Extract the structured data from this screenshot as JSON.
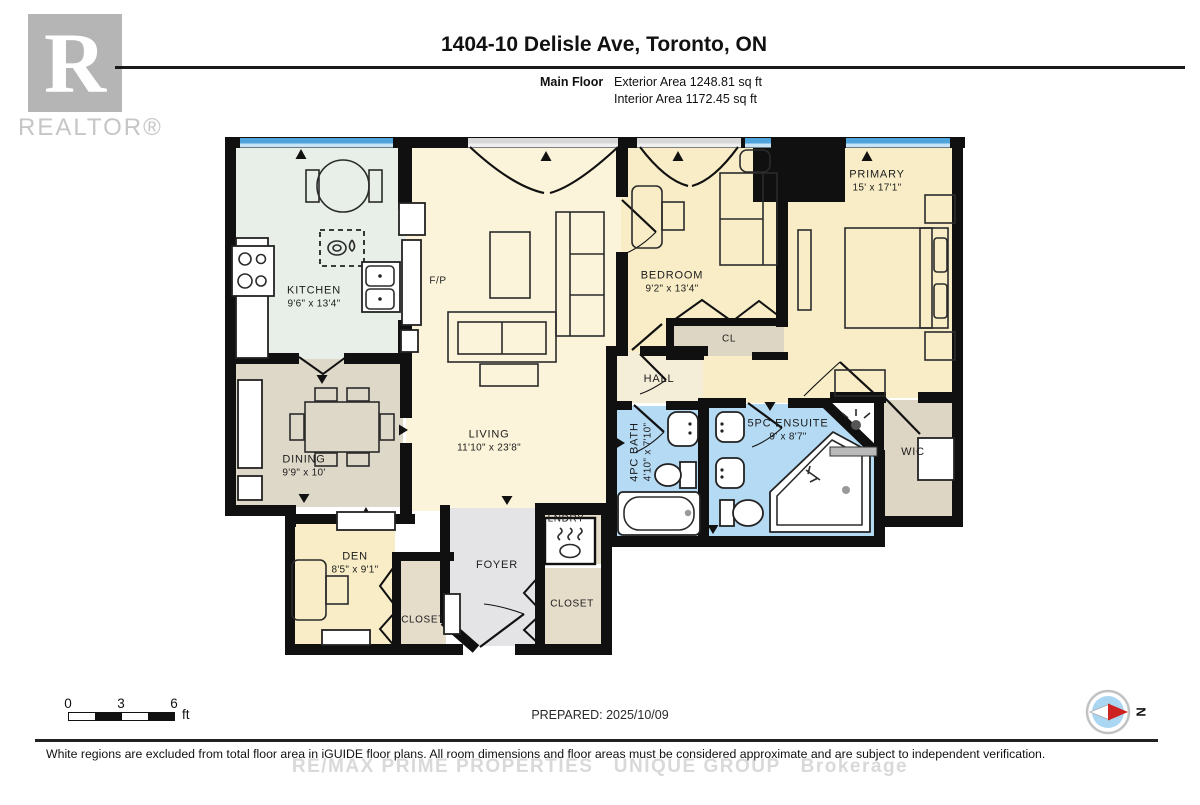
{
  "header": {
    "title": "1404-10 Delisle Ave, Toronto, ON",
    "floor_label": "Main Floor",
    "exterior_area": "Exterior Area 1248.81 sq ft",
    "interior_area": "Interior Area 1172.45 sq ft",
    "logo_letter": "R",
    "logo_word": "REALTOR®"
  },
  "rooms": {
    "kitchen": {
      "name": "KITCHEN",
      "dims": "9'6\" x 13'4\""
    },
    "living": {
      "name": "LIVING",
      "dims": "11'10\" x 23'8\""
    },
    "dining": {
      "name": "DINING",
      "dims": "9'9\" x 10'"
    },
    "den": {
      "name": "DEN",
      "dims": "8'5\" x 9'1\""
    },
    "bedroom": {
      "name": "BEDROOM",
      "dims": "9'2\" x 13'4\""
    },
    "primary": {
      "name": "PRIMARY",
      "dims": "15' x 17'1\""
    },
    "bath": {
      "name": "4PC BATH",
      "dims": "4'10\" x 7'10\""
    },
    "ensuite": {
      "name": "5PC ENSUITE",
      "dims": "9' x 8'7\""
    },
    "wic": {
      "name": "WIC"
    },
    "hall": {
      "name": "HALL"
    },
    "cl": {
      "name": "CL"
    },
    "foyer": {
      "name": "FOYER"
    },
    "laundry": {
      "name": "LNDRY"
    },
    "closet_den": {
      "name": "CLOSET"
    },
    "closet_foyer": {
      "name": "CLOSET"
    },
    "fireplace": {
      "name": "F/P"
    }
  },
  "footer": {
    "scale": {
      "ticks": [
        "0",
        "3",
        "6"
      ],
      "unit": "ft"
    },
    "prepared": "PREPARED: 2025/10/09",
    "compass_label": "N",
    "disclaimer": "White regions are excluded from total floor area in iGUIDE floor plans. All room dimensions and floor areas must be considered approximate and are subject to independent verification.",
    "watermark": "RE/MAX PRIME PROPERTIES   UNIQUE GROUP   Brokerage"
  },
  "colors": {
    "kitchen": "#e7efe8",
    "cream1": "#fbf4da",
    "cream2": "#f8edc7",
    "greige": "#ded6c5",
    "greige2": "#ded8c9",
    "tan": "#f4edd8",
    "blue": "#b5daf3",
    "gray": "#e4e4e6",
    "closet": "#e5dcca",
    "window": "#4ea4da"
  }
}
